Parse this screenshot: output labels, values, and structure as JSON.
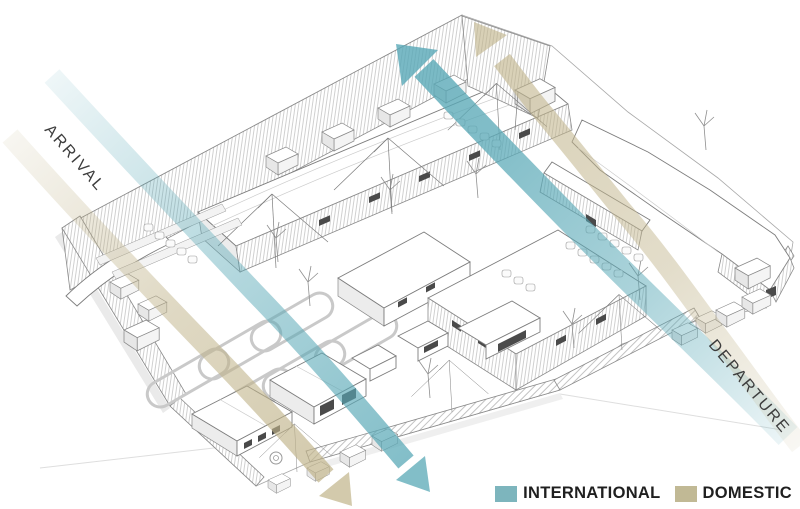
{
  "page": {
    "background": "#ffffff"
  },
  "annotations": {
    "arrival": "ARRIVAL",
    "departure": "DEPARTURE"
  },
  "legend": {
    "items": [
      {
        "id": "international",
        "label": "INTERNATIONAL",
        "color": "#7db5bd"
      },
      {
        "id": "domestic",
        "label": "DOMESTIC",
        "color": "#c1b995"
      }
    ]
  },
  "flows": [
    {
      "name": "international-arrival",
      "category": "INTERNATIONAL",
      "direction": "enters upper-left (ARRIVAL side), exits bottom-center with arrowhead"
    },
    {
      "name": "international-departure",
      "category": "INTERNATIONAL",
      "direction": "enters lower-right (DEPARTURE side), exits top-center with arrowhead"
    },
    {
      "name": "domestic-arrival",
      "category": "DOMESTIC",
      "direction": "enters upper-left (ARRIVAL side), exits bottom-center with arrowhead"
    },
    {
      "name": "domestic-departure",
      "category": "DOMESTIC",
      "direction": "enters lower-right (DEPARTURE side), curves up, exits top-center with arrowhead"
    }
  ],
  "colors": {
    "international_flow": "#58a8b6",
    "domestic_flow": "#c0b389",
    "linework": "#808080"
  }
}
